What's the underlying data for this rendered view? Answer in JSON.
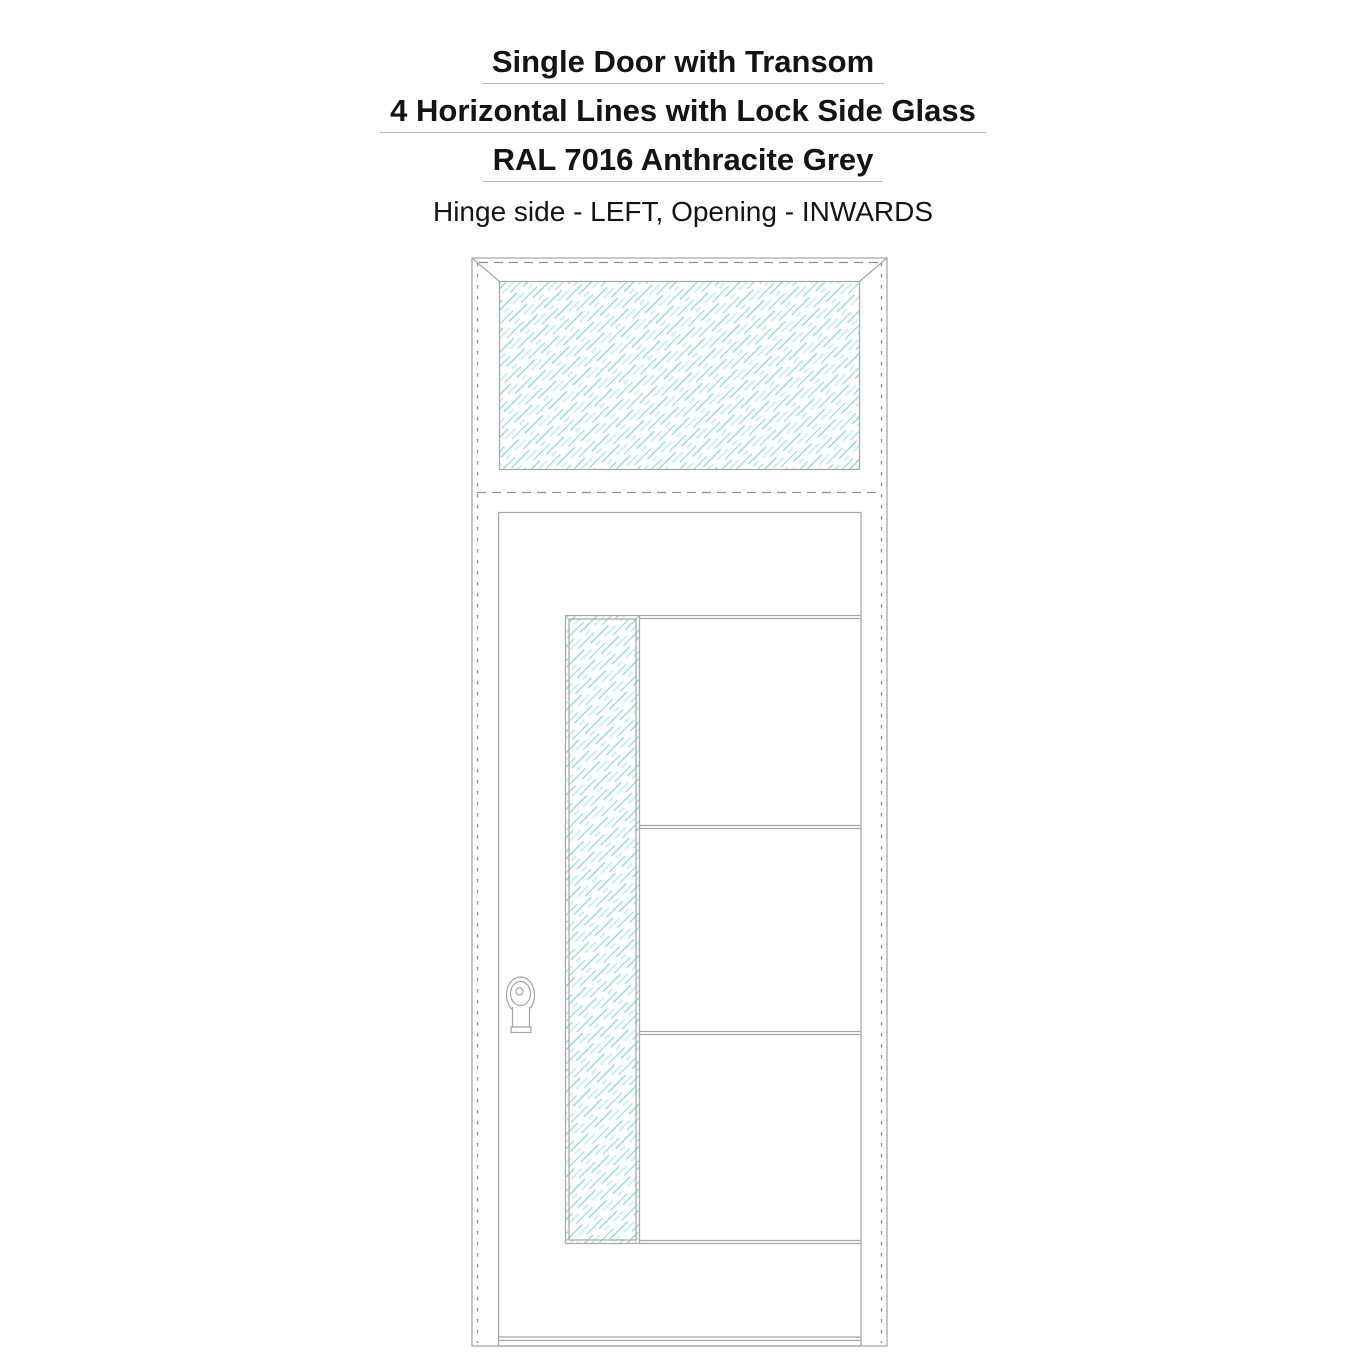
{
  "header": {
    "title": "Single Door with Transom",
    "subtitle": "4 Horizontal Lines with Lock Side Glass",
    "finish": "RAL 7016 Anthracite Grey",
    "configuration": "Hinge side - LEFT, Opening - INWARDS"
  },
  "drawing": {
    "door_type": "Single Door with Transom",
    "design": "4 Horizontal Lines with Lock Side Glass",
    "finish_color_name": "RAL 7016 Anthracite Grey",
    "hinge_side": "LEFT",
    "opening": "INWARDS",
    "horizontal_lines_count": 4,
    "glass_panels": [
      "transom-glass",
      "lock-side-glass-strip"
    ],
    "colors": {
      "background": "#ffffff",
      "outline": "#a8a8a8",
      "dashed": "#8f8f8f",
      "hatch_strong": "#8ad4d6",
      "hatch_light": "#c9eded",
      "text": "#141414",
      "underline": "#b8b8b8"
    }
  }
}
